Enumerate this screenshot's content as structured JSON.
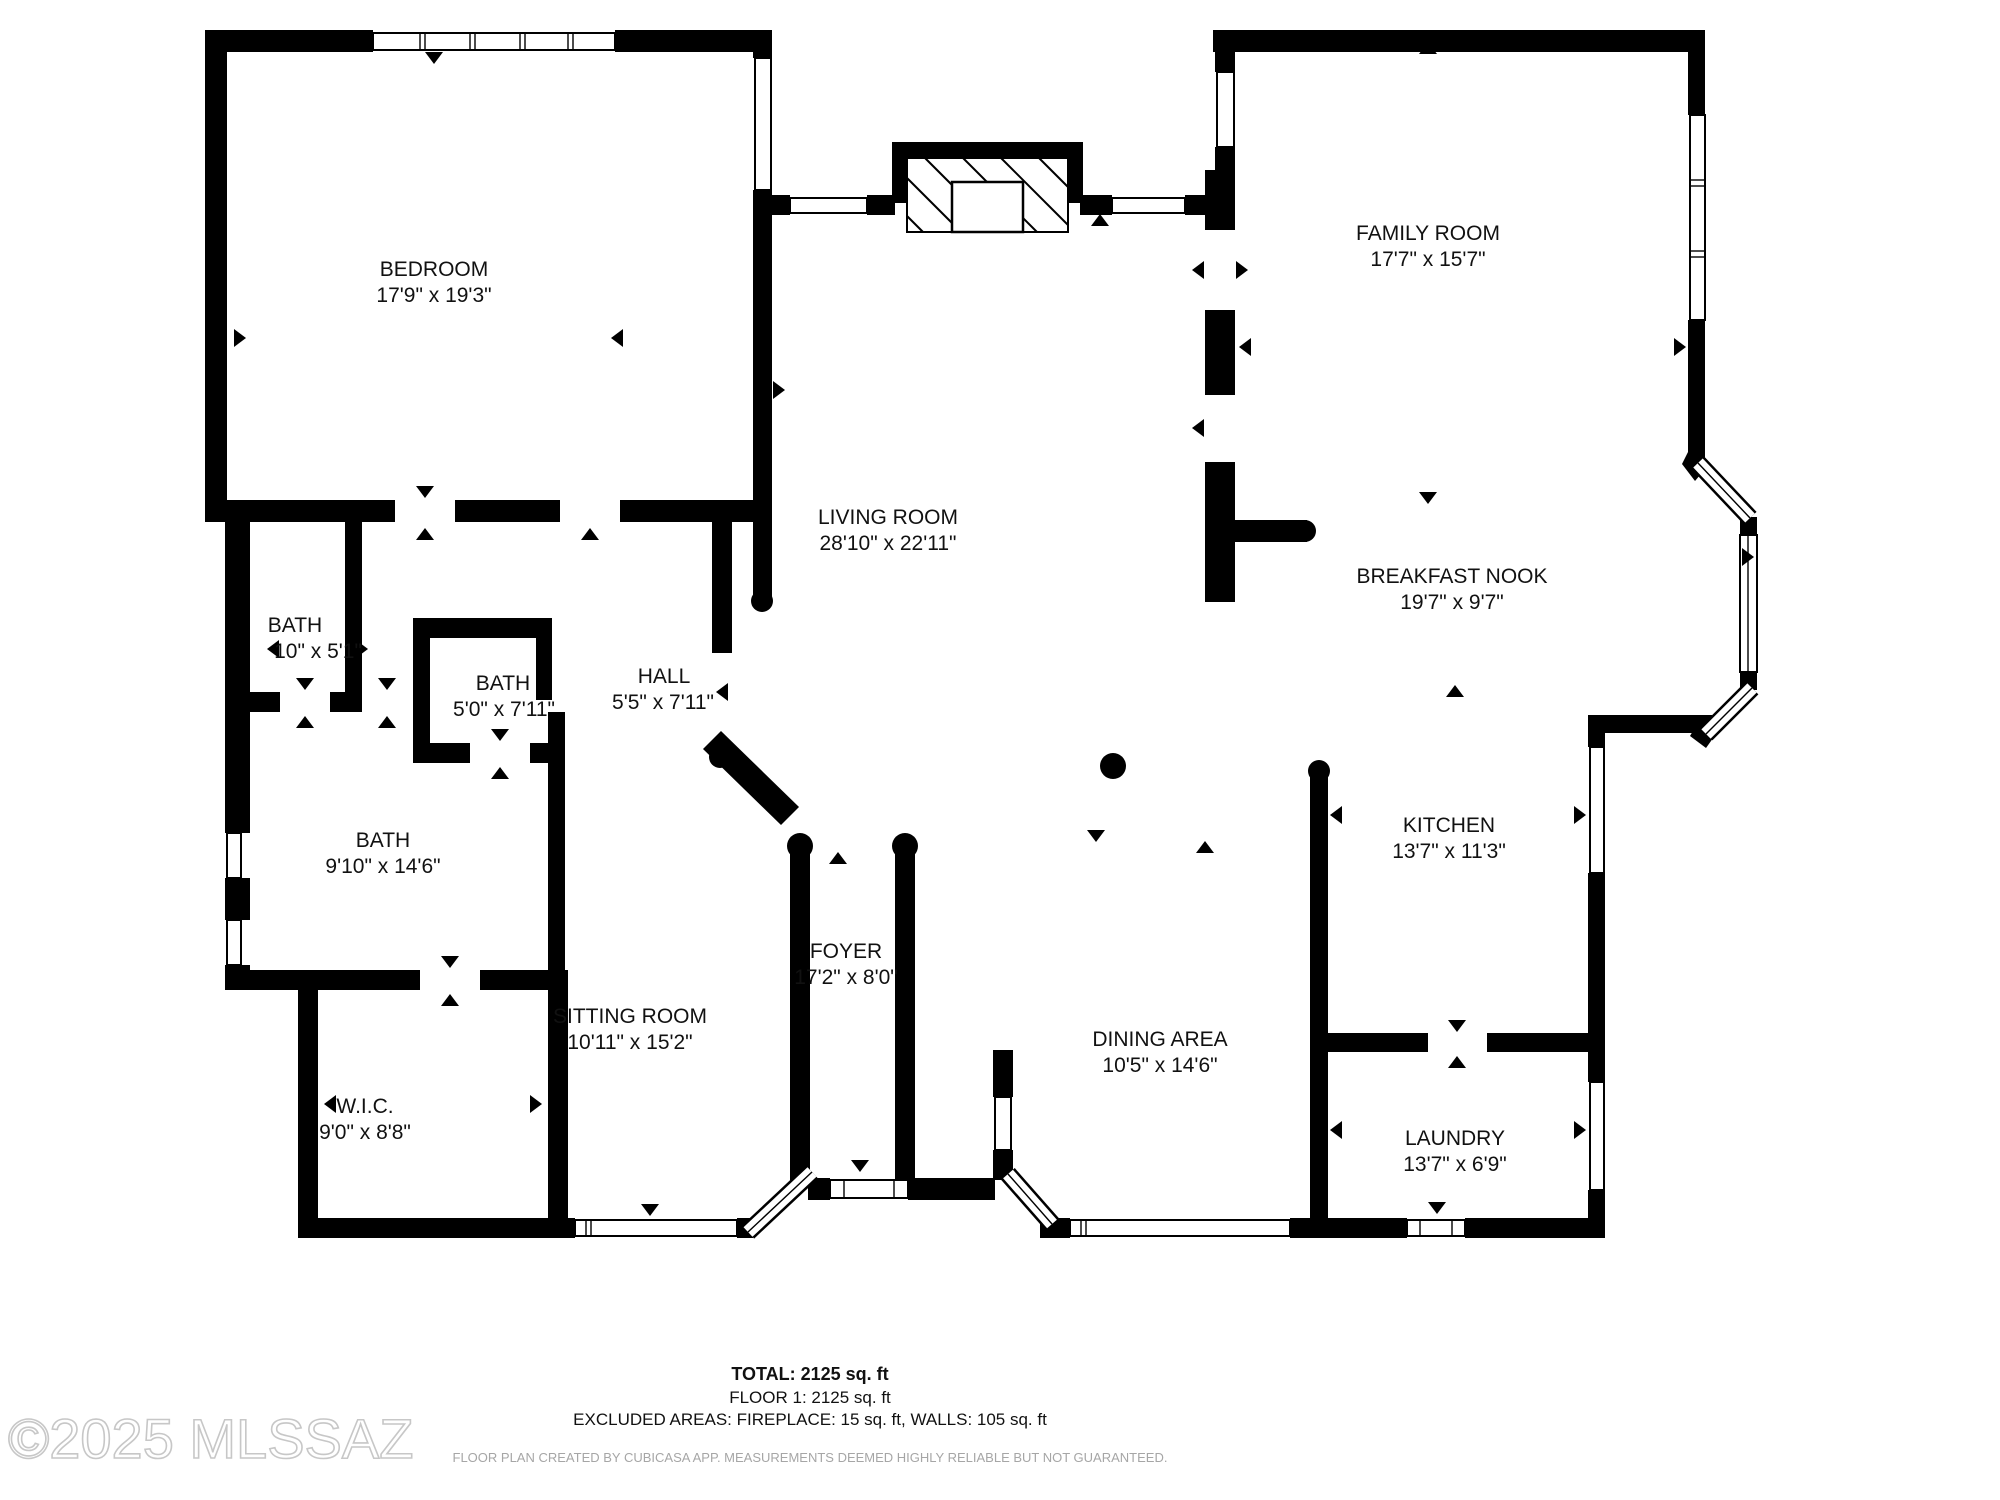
{
  "plan": {
    "rooms": [
      {
        "name": "BEDROOM",
        "dims": "17'9\" x 19'3\""
      },
      {
        "name": "LIVING ROOM",
        "dims": "28'10\" x 22'11\""
      },
      {
        "name": "FAMILY ROOM",
        "dims": "17'7\" x 15'7\""
      },
      {
        "name": "BREAKFAST NOOK",
        "dims": "19'7\" x 9'7\""
      },
      {
        "name": "KITCHEN",
        "dims": "13'7\" x 11'3\""
      },
      {
        "name": "LAUNDRY",
        "dims": "13'7\" x 6'9\""
      },
      {
        "name": "DINING AREA",
        "dims": "10'5\" x 14'6\""
      },
      {
        "name": "FOYER",
        "dims": "17'2\" x 8'0\""
      },
      {
        "name": "SITTING ROOM",
        "dims": "10'11\" x 15'2\""
      },
      {
        "name": "W.I.C.",
        "dims": "9'0\" x 8'8\""
      },
      {
        "name": "BATH",
        "dims": "9'10\" x 14'6\""
      },
      {
        "name": "BATH",
        "dims": "5'0\" x 7'11\""
      },
      {
        "name": "BATH",
        "dims": "10\" x 5'1\""
      },
      {
        "name": "HALL",
        "dims": "5'5\" x 7'11\""
      }
    ]
  },
  "footer": {
    "total": "TOTAL: 2125 sq. ft",
    "floor": "FLOOR 1: 2125 sq. ft",
    "excluded": "EXCLUDED AREAS: FIREPLACE: 15 sq. ft, WALLS: 105 sq. ft",
    "disclaimer": "FLOOR PLAN CREATED BY CUBICASA APP. MEASUREMENTS DEEMED HIGHLY RELIABLE BUT NOT GUARANTEED."
  },
  "watermark": "©2025 MLSSAZ"
}
